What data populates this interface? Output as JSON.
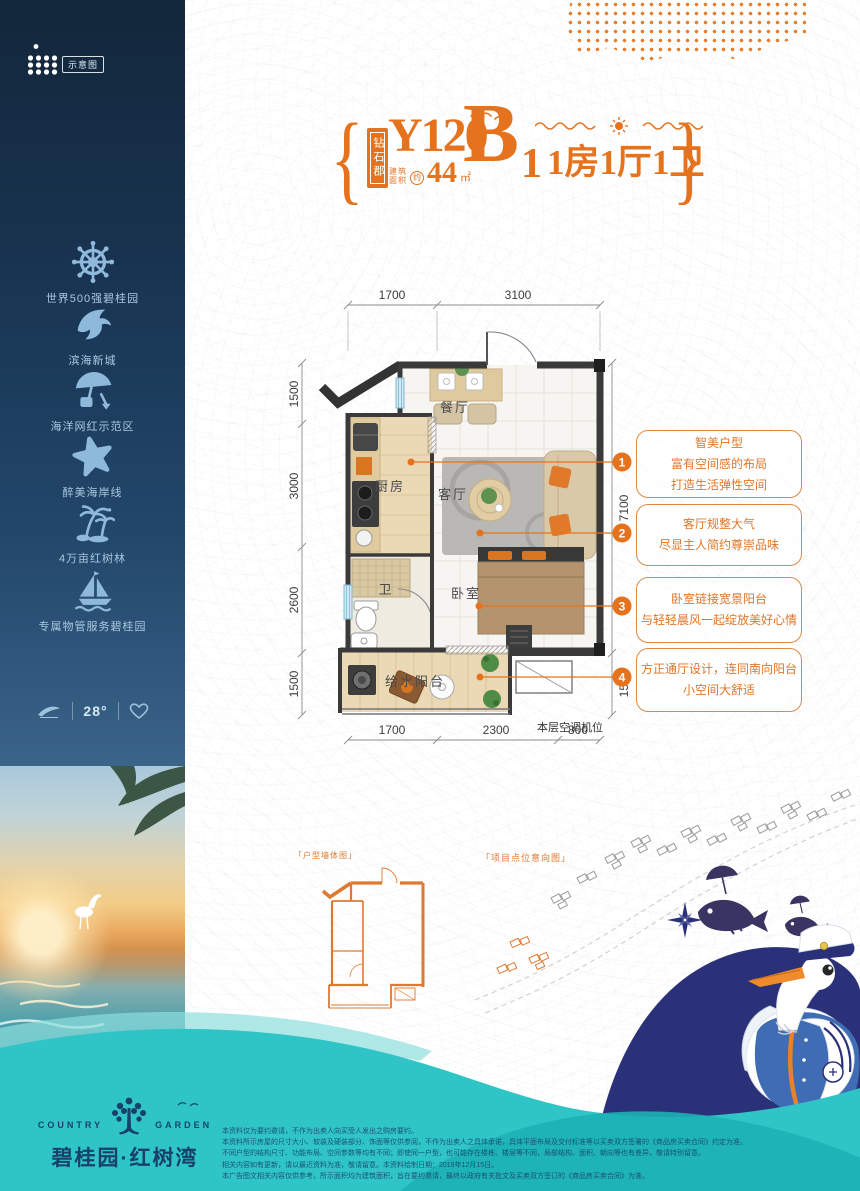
{
  "schematic_badge": "示意图",
  "sidebar": {
    "features": [
      {
        "icon": "ship-wheel-icon",
        "label": "世界500强碧桂园"
      },
      {
        "icon": "dolphin-icon",
        "label": "滨海新城"
      },
      {
        "icon": "beach-umbrella-icon",
        "label": "海洋网红示范区"
      },
      {
        "icon": "starfish-icon",
        "label": "醉美海岸线"
      },
      {
        "icon": "palm-trees-icon",
        "label": "4万亩红树林"
      },
      {
        "icon": "sailboat-icon",
        "label": "专属物管服务碧桂园"
      }
    ],
    "badge_temperature": "28°"
  },
  "title": {
    "estate_tag": "钻石郡",
    "model_code": "Y120",
    "area_label_1": "建筑",
    "area_label_2": "面积",
    "area_approx": "约",
    "area_value": "44",
    "area_unit": "㎡",
    "block_letter": "B",
    "block_number": "1",
    "layout_text": "1房1厅1卫"
  },
  "floor_plan": {
    "rooms": {
      "dining": "餐厅",
      "kitchen": "厨房",
      "living": "客厅",
      "bathroom": "卫",
      "bedroom": "卧室",
      "balcony": "给水阳台"
    },
    "ac_label": "本层空调机位",
    "dimensions": {
      "top": [
        "1700",
        "3100"
      ],
      "bottom": [
        "1700",
        "2300",
        "800"
      ],
      "left": [
        "1500",
        "3000",
        "2600",
        "1500"
      ],
      "right": [
        "7100",
        "1500"
      ]
    }
  },
  "callouts": [
    {
      "number": "1",
      "lines": [
        "智美户型",
        "富有空间感的布局",
        "打造生活弹性空间"
      ]
    },
    {
      "number": "2",
      "lines": [
        "客厅规整大气",
        "尽显主人简约尊崇品味"
      ]
    },
    {
      "number": "3",
      "lines": [
        "卧室链接宽景阳台",
        "与轻轻晨风一起绽放美好心情"
      ]
    },
    {
      "number": "4",
      "lines": [
        "方正通厅设计，连同南向阳台",
        "小空间大舒适"
      ]
    }
  ],
  "mini_diagrams": {
    "unit_wall_label": "「户型墙体图」",
    "site_map_label": "「项目点位意向图」"
  },
  "footer": {
    "brand_en_left": "COUNTRY",
    "brand_en_right": "GARDEN",
    "brand_cn": "碧桂园·红树湾",
    "disclaimer_lines": [
      "本资料仅为要约邀请，不作为出卖人向买受人发出之购房要约。",
      "本资料所示房屋的尺寸大小、软装及硬装部分、饰面等仅供参阅，不作为出卖人之具体承诺，具体平面布局及交付标准等以买卖双方签署的《商品房买卖合同》约定为准。",
      "不同户型的结构尺寸、功能布局、空间参数等均有不同；即使同一户型，也可能存在楼栋、楼层等不同，局部结构、面积、朝向等也有差异，敬请特别留意。",
      "相关内容如有更新，请以最近资料为准，敬请留意。本资料绘制日期：2019年12月15日。",
      "本广告图文相关内容仅供参考，所示面积均为建筑面积，旨在要约邀请，最终以政府有关批文及买卖双方签订的《商品房买卖合同》为准。"
    ]
  },
  "colors": {
    "accent_orange": "#e5731e",
    "teal_wave": "#2fc5c6",
    "navy_wave": "#2b3178",
    "sidebar_navy": "#183350"
  }
}
